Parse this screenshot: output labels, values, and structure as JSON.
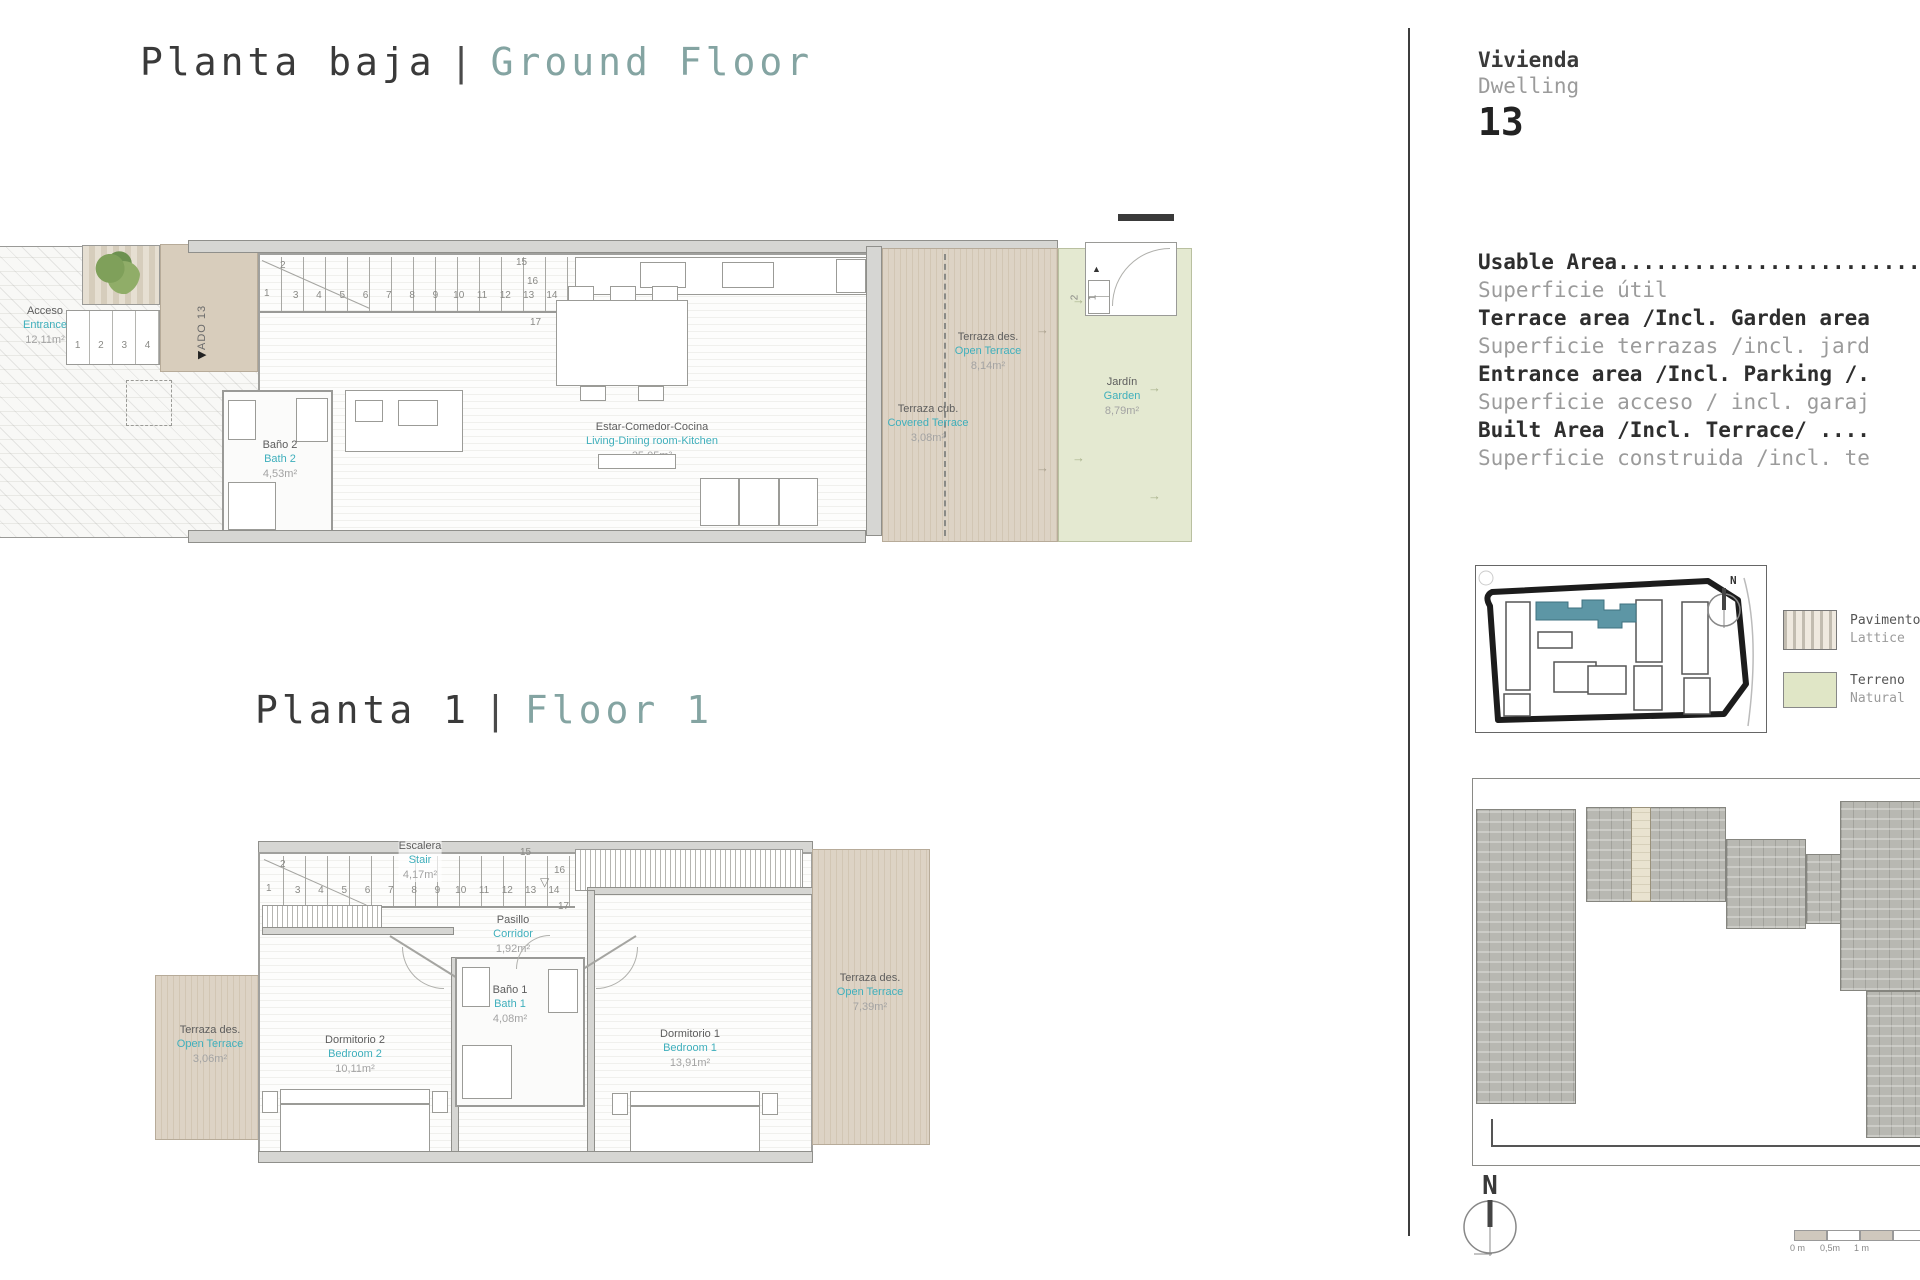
{
  "titles": {
    "ground": {
      "es": "Planta baja",
      "sep": "|",
      "en": "Ground Floor"
    },
    "floor1": {
      "es": "Planta 1",
      "sep": "|",
      "en": "Floor 1"
    }
  },
  "ground": {
    "rooms": {
      "acceso": {
        "es": "Acceso",
        "en": "Entrance",
        "area": "12,11m²"
      },
      "bath2": {
        "es": "Baño 2",
        "en": "Bath 2",
        "area": "4,53m²"
      },
      "living": {
        "es": "Estar-Comedor-Cocina",
        "en": "Living-Dining room-Kitchen",
        "area": "35,05m²"
      },
      "terrace_open": {
        "es": "Terraza des.",
        "en": "Open Terrace",
        "area": "8,14m²"
      },
      "terrace_cov": {
        "es": "Terraza cub.",
        "en": "Covered Terrace",
        "area": "3,08m²"
      },
      "garden": {
        "es": "Jardín",
        "en": "Garden",
        "area": "8,79m²"
      }
    },
    "ado_label": "ADO 13",
    "stair": {
      "first": "1",
      "second": "2",
      "row": [
        "3",
        "4",
        "5",
        "6",
        "7",
        "8",
        "9",
        "10",
        "11",
        "12",
        "13",
        "14"
      ],
      "n15": "15",
      "n16": "16",
      "n17": "17"
    },
    "entry_steps": [
      "1",
      "2",
      "3",
      "4"
    ],
    "garden_steps": {
      "s2": "2",
      "s1": "1"
    }
  },
  "floor1": {
    "rooms": {
      "stair": {
        "es": "Escalera",
        "en": "Stair",
        "area": "4,17m²"
      },
      "corridor": {
        "es": "Pasillo",
        "en": "Corridor",
        "area": "1,92m²"
      },
      "bath1": {
        "es": "Baño 1",
        "en": "Bath 1",
        "area": "4,08m²"
      },
      "bed2": {
        "es": "Dormitorio 2",
        "en": "Bedroom 2",
        "area": "10,11m²"
      },
      "bed1": {
        "es": "Dormitorio 1",
        "en": "Bedroom 1",
        "area": "13,91m²"
      },
      "terrace_left": {
        "es": "Terraza des.",
        "en": "Open Terrace",
        "area": "3,06m²"
      },
      "terrace_right": {
        "es": "Terraza des.",
        "en": "Open Terrace",
        "area": "7,39m²"
      }
    },
    "stair": {
      "first": "1",
      "second": "2",
      "row": [
        "3",
        "4",
        "5",
        "6",
        "7",
        "8",
        "9",
        "10",
        "11",
        "12",
        "13",
        "14"
      ],
      "n15": "15",
      "n16": "16",
      "n17": "17"
    }
  },
  "panel": {
    "dwelling": {
      "es": "Vivienda",
      "en": "Dwelling",
      "number": "13"
    },
    "areas": [
      {
        "en": "Usable Area........................",
        "es": "Superficie útil"
      },
      {
        "en": "Terrace area /Incl. Garden area",
        "es": "Superficie terrazas /incl. jard"
      },
      {
        "en": "Entrance area /Incl. Parking /.",
        "es": "Superficie acceso / incl. garaj"
      },
      {
        "en": "Built Area /Incl. Terrace/ ....",
        "es": "Superficie construida /incl. te"
      }
    ],
    "legend": [
      {
        "es": "Pavimento",
        "en": "Lattice"
      },
      {
        "es": "Terreno",
        "en": "Natural"
      }
    ],
    "scale_labels": [
      "0 m",
      "0,5m",
      "1 m"
    ]
  },
  "misc": {
    "arrow": "→",
    "arrow_up": "▲",
    "arrow_right": "▶",
    "arrow_down": "▽",
    "north": "N"
  },
  "colors": {
    "label_teal": "#3fafbc",
    "title_teal": "#84a4a2",
    "terrace_beige": "#d9cfc0",
    "garden_green": "#e4e9d1",
    "site_highlight": "#5d96a5"
  }
}
